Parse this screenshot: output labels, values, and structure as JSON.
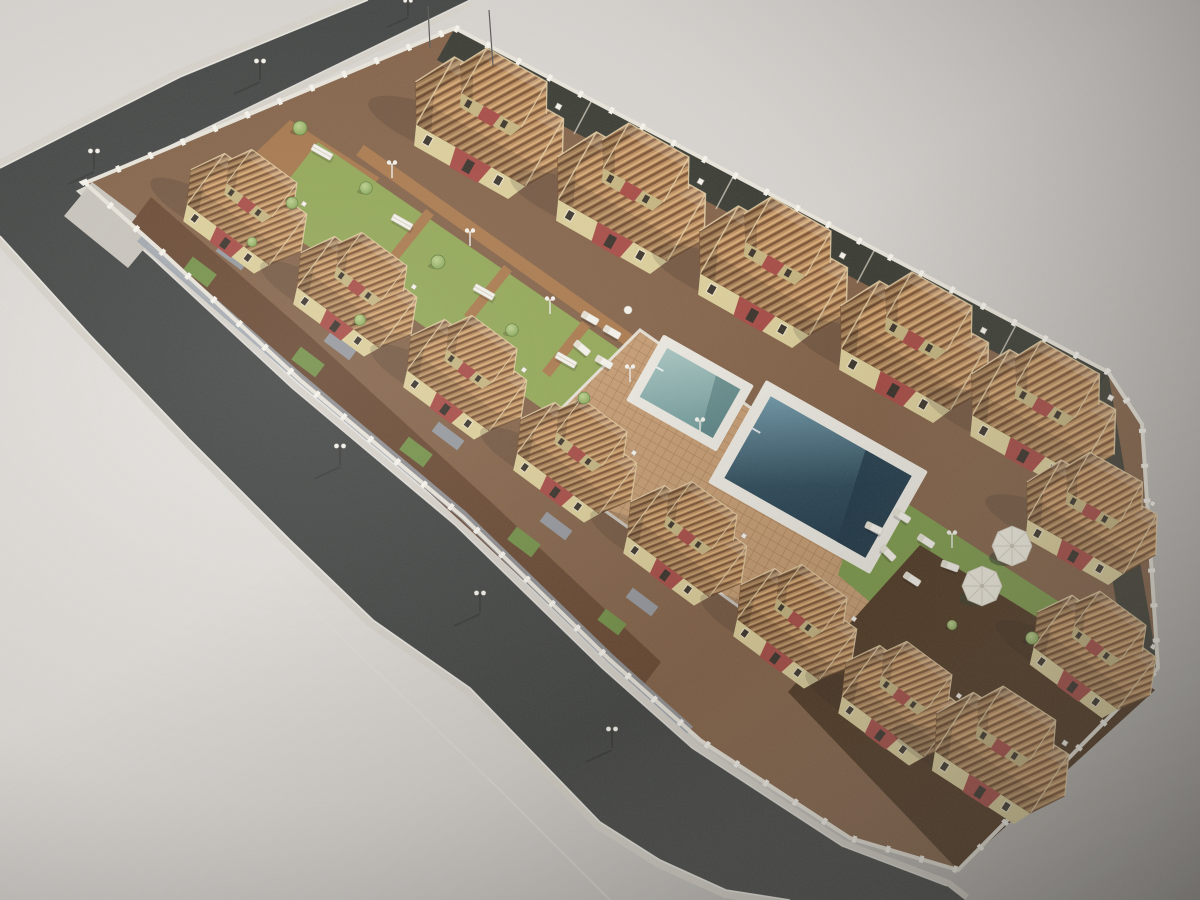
{
  "scene": {
    "description": "Aerial isometric 3D architectural rendering of a gated residential townhouse complex with terracotta hip roofs, a central landscaped courtyard, two swimming pools, a paved sun deck with parasols and loungers, a white perimeter wall with pillars, and a dark asphalt road wrapping the north-west and south-west sides",
    "type": "architectural-visualization",
    "view": "aerial-isometric",
    "elements": {
      "townhouses_top_row": 5,
      "townhouses_left_row": 7,
      "townhouses_east_cluster": 3,
      "swimming_pools": 2,
      "parasols": 2,
      "sun_loungers": 10,
      "garden_benches": 4,
      "trees": 10,
      "street_lamps": 6,
      "garden_lamps": 6
    }
  },
  "palette": {
    "bg-light": "#e6e3df",
    "bg-mid": "#d3d0cc",
    "bg-dark": "#8f8d8b",
    "road": "#454746",
    "road-edge": "#2e302f",
    "sidewalk": "#d7d3cb",
    "curb": "#f0eee7",
    "seam": "#e2dfda",
    "wall-top": "#e9e5db",
    "pillar": "#f7f4ed",
    "roof-tile": "#bd8f60",
    "roof-groove": "#7f5636",
    "roof-light": "#dcb27c",
    "roof-ridge": "#e4cfa6",
    "wall-cream": "#ddcf9b",
    "wall-cream-dark": "#c6b581",
    "wall-red": "#a84c46",
    "wall-red-dark": "#8d3b38",
    "win": "#3c352c",
    "win-frame": "#efe6cc",
    "lawn": "#93a857",
    "lawn-dark": "#75924a",
    "lawn-right": "#7e9b4c",
    "deck": "#c59c73",
    "deck-line": "#a67c54",
    "path-brown": "#ab7a4e",
    "plot-base": "#85644a",
    "dirt": "#6a4a34",
    "dirt-dark": "#503823",
    "backyard": "#363b34",
    "drive": "#98a0aa",
    "white": "#f5f3ec",
    "umbrella": "#f3efe3",
    "umbrella-rib": "#d9d4c6",
    "pool-border": "#eceae2",
    "pool-small-a": "#a8c6c2",
    "pool-small-b": "#6d9899",
    "pool-big-a": "#7199a9",
    "pool-big-b": "#2f4c5c",
    "pool-big-c": "#22394a",
    "sand": "#b08a5c",
    "shadow": "#1d1d1b"
  }
}
